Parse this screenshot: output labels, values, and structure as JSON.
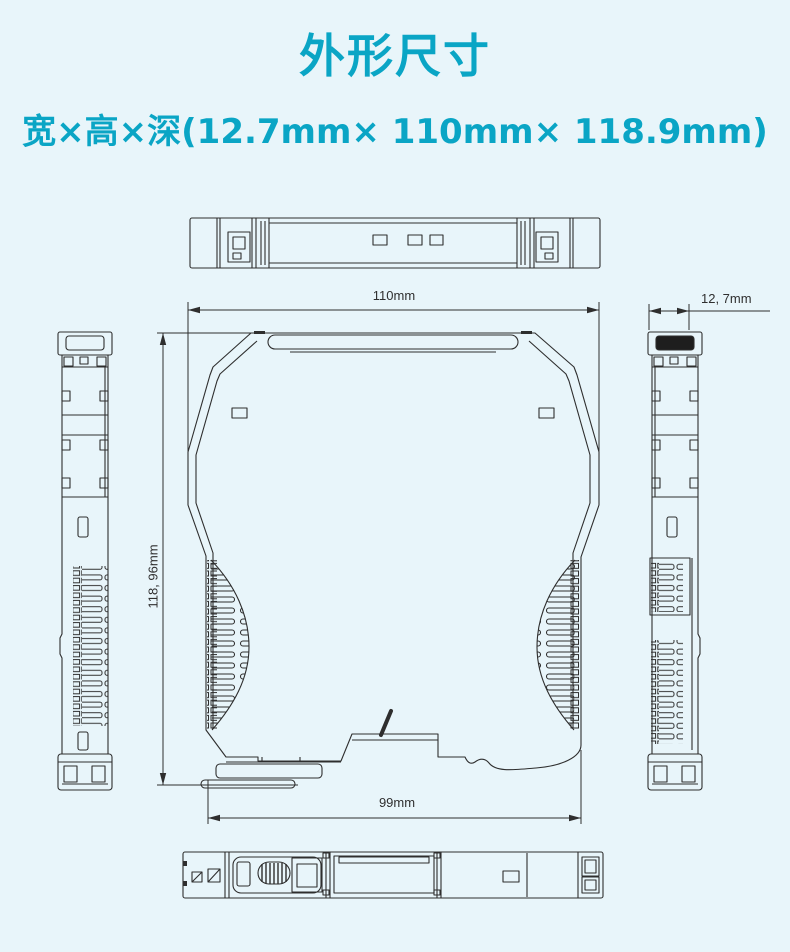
{
  "header": {
    "title": "外形尺寸",
    "subtitle": "宽×高×深(12.7mm× 110mm× 118.9mm)"
  },
  "drawing": {
    "dim_top_width": "110mm",
    "dim_left_height": "118, 96mm",
    "dim_bottom_width": "99mm",
    "dim_side_width": "12, 7mm"
  },
  "colors": {
    "accent": "#0aa5c5",
    "background": "#e8f5fa",
    "line": "#2e2e2e",
    "dim_text": "#2f2f2f"
  }
}
